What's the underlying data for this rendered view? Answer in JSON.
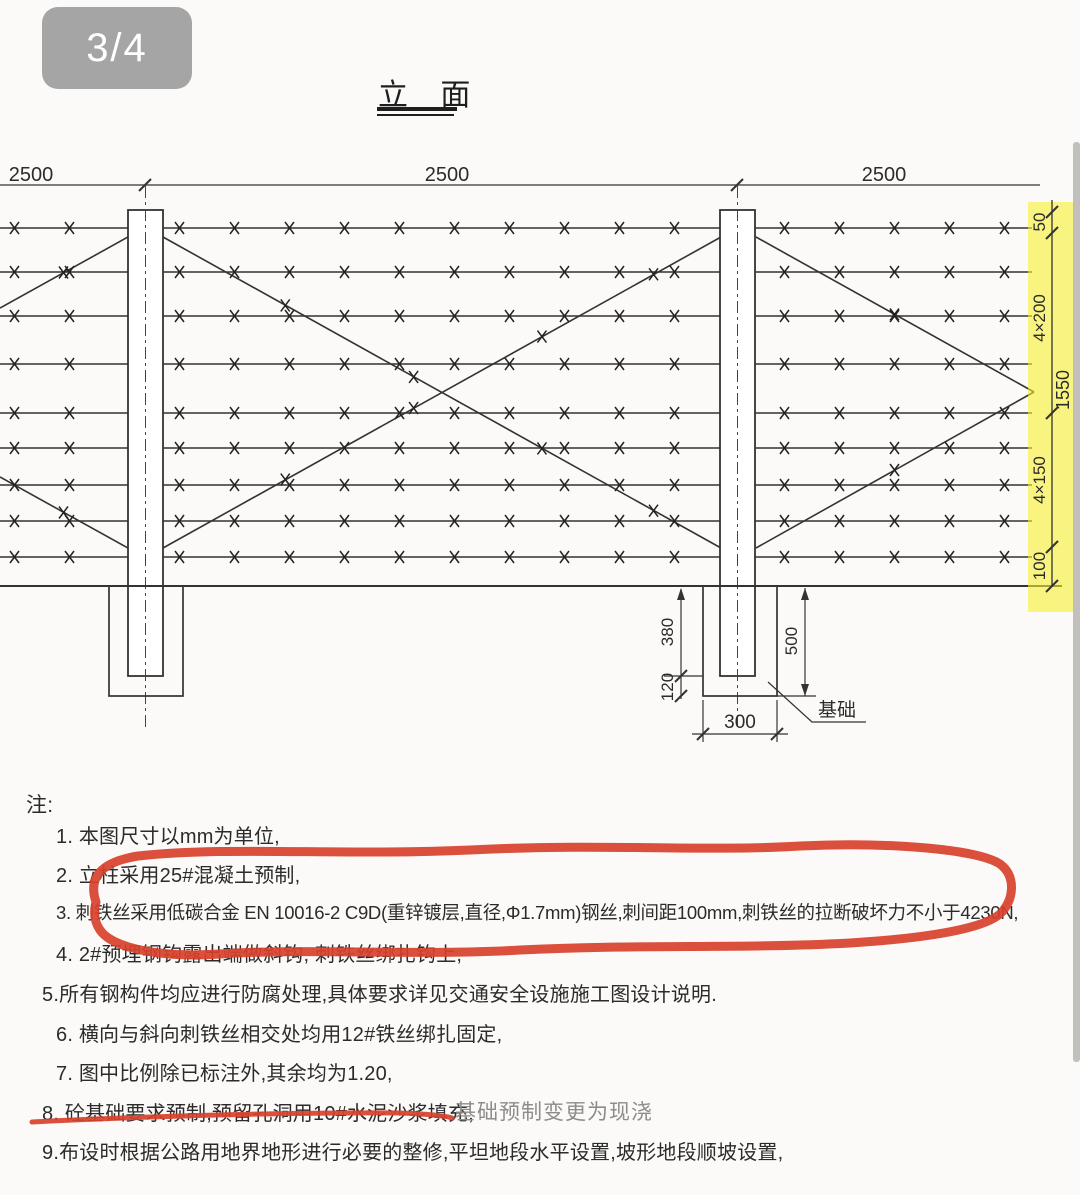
{
  "page": {
    "badge_label": "3/4",
    "title": "立 面"
  },
  "drawing": {
    "top_dims": {
      "left": "2500",
      "middle": "2500",
      "right": "2500"
    },
    "right_dims": {
      "gap_top": "50",
      "upper": "4×200",
      "overall": "1550",
      "lower": "4×150",
      "gap_bottom": "100"
    },
    "foundation_dims": {
      "embed": "380",
      "below": "120",
      "depth": "500",
      "width": "300",
      "label": "基础"
    }
  },
  "notes": {
    "heading": "注:",
    "items": [
      "1. 本图尺寸以mm为单位,",
      "2. 立柱采用25#混凝土预制,",
      "3. 刺铁丝采用低碳合金 EN 10016-2 C9D(重锌镀层,直径,Φ1.7mm)钢丝,刺间距100mm,刺铁丝的拉断破坏力不小于4230N,",
      "4. 2#预埋钢钩露出端做斜钩, 刺铁丝绑扎钩上,",
      "5.所有钢构件均应进行防腐处理,具体要求详见交通安全设施施工图设计说明.",
      "6. 横向与斜向刺铁丝相交处均用12#铁丝绑扎固定,",
      "7. 图中比例除已标注外,其余均为1.20,",
      "8. 砼基础要求预制,预留孔洞用10#水泥沙浆填充,",
      "9.布设时根据公路用地界地形进行必要的整修,平坦地段水平设置,坡形地段顺坡设置,"
    ],
    "revision_text": "基础预制变更为现浇"
  },
  "colors": {
    "annotation_red": "#d8402c",
    "highlight_yellow": "#f8ef2f",
    "revision_gray": "#8e8c88",
    "line_dark": "#2f2f2f"
  }
}
